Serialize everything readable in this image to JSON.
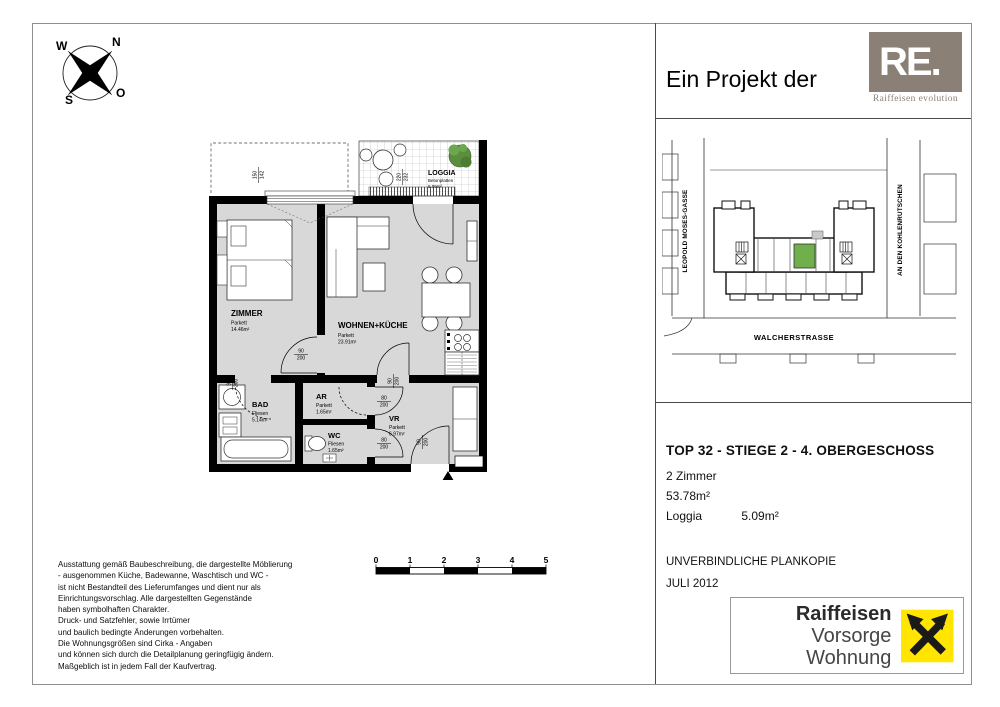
{
  "compass": {
    "n": "N",
    "w": "W",
    "s": "S",
    "o": "O"
  },
  "header": {
    "project_text": "Ein Projekt der",
    "re_logo": "RE.",
    "re_caption": "Raiffeisen evolution",
    "re_color": "#8b8076"
  },
  "site_map": {
    "street_left": "LEOPOLD MOSES-GASSE",
    "street_right": "AN DEN KOHLENRUTSCHEN",
    "street_bottom": "WALCHERSTRASSE",
    "unit_color": "#6fb04c"
  },
  "info": {
    "title": "TOP 32 - STIEGE 2 - 4. OBERGESCHOSS",
    "rooms_count": "2 Zimmer",
    "area": "53.78m²",
    "loggia_label": "Loggia",
    "loggia_area": "5.09m²",
    "plan_copy": "UNVERBINDLICHE PLANKOPIE",
    "date": "JULI 2012"
  },
  "brand": {
    "name": "Raiffeisen",
    "subtitle": "Vorsorge Wohnung",
    "logo_color": "#ffe500"
  },
  "plan": {
    "floor_color": "#d8d8d8",
    "rooms": {
      "zimmer": {
        "name": "ZIMMER",
        "floor": "Parkett",
        "area": "14.46m²"
      },
      "wohnen": {
        "name": "WOHNEN+KÜCHE",
        "floor": "Parkett",
        "area": "23.91m²"
      },
      "bad": {
        "name": "BAD",
        "floor": "Fliesen",
        "area": "5.14m²"
      },
      "ar": {
        "name": "AR",
        "floor": "Parkett",
        "area": "1.65m²"
      },
      "wc": {
        "name": "WC",
        "floor": "Fliesen",
        "area": "1.65m²"
      },
      "vr": {
        "name": "VR",
        "floor": "Parkett",
        "area": "6.97m²"
      },
      "loggia": {
        "name": "LOGGIA",
        "floor": "Betonplatten",
        "area": "5.09m²"
      }
    },
    "dims": {
      "door90": {
        "n": "90",
        "d": "200"
      },
      "door80": {
        "n": "80",
        "d": "200"
      },
      "window": {
        "n": "150",
        "d": "142"
      },
      "loggia": {
        "n": "220",
        "d": "232"
      }
    }
  },
  "scalebar": {
    "labels": [
      "0",
      "1",
      "2",
      "3",
      "4",
      "5"
    ]
  },
  "disclaimer": {
    "lines": [
      "Ausstattung gemäß Baubeschreibung, die dargestellte Möblierung",
      "- ausgenommen Küche, Badewanne, Waschtisch und WC -",
      "ist nicht Bestandteil des Lieferumfanges und dient nur als",
      "Einrichtungsvorschlag. Alle dargestellten Gegenstände",
      "haben symbolhaften Charakter.",
      "Druck- und Satzfehler, sowie Irrtümer",
      "und baulich bedingte Änderungen vorbehalten.",
      "Die Wohnungsgrößen sind Cirka - Angaben",
      "und können sich durch die Detailplanung geringfügig ändern.",
      "Maßgeblich ist in jedem Fall der Kaufvertrag."
    ]
  }
}
